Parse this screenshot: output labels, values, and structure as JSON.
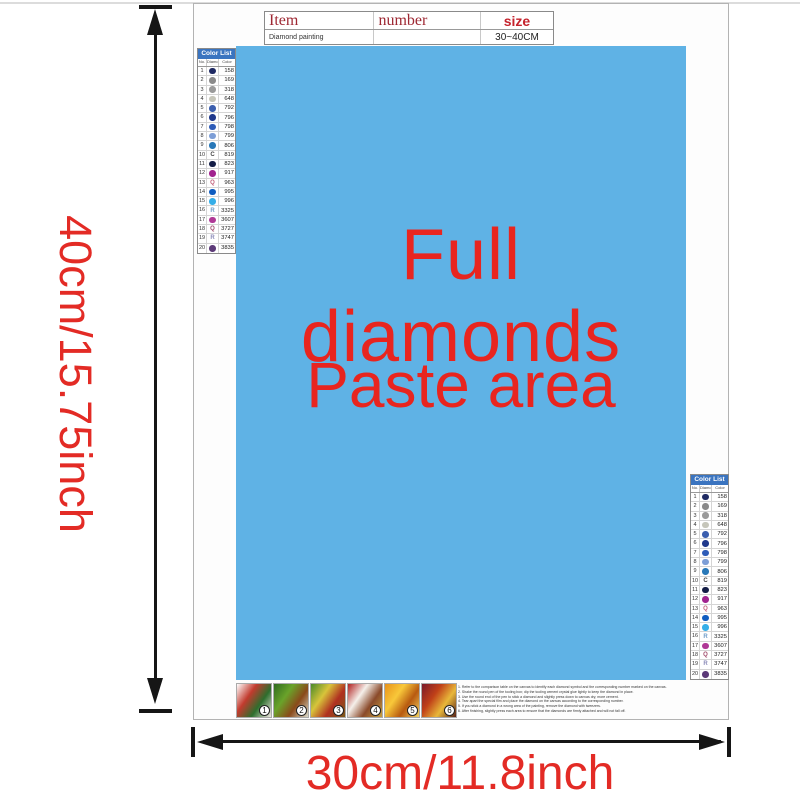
{
  "dimensions": {
    "height_label": "40cm/15.75inch",
    "width_label": "30cm/11.8inch"
  },
  "header_table": {
    "columns": [
      "Item",
      "number",
      "size"
    ],
    "row": {
      "item": "Diamond painting",
      "number": "",
      "size": "30~40CM"
    }
  },
  "paste_area": {
    "line1": "Full diamonds",
    "line2": "Paste area",
    "bg_color": "#5fb2e5",
    "text_color": "#e8251f"
  },
  "color_list": {
    "title": "Color List",
    "columns": [
      "No.",
      "Diamond",
      "Color"
    ],
    "header_bg": "#3a74c0",
    "rows": [
      {
        "no": "1",
        "type": "dot",
        "glyph": "",
        "color": "#1f2a63",
        "code": "158"
      },
      {
        "no": "2",
        "type": "dot",
        "glyph": "",
        "color": "#8a8a8a",
        "code": "169"
      },
      {
        "no": "3",
        "type": "dot",
        "glyph": "",
        "color": "#9a9a9a",
        "code": "318"
      },
      {
        "no": "4",
        "type": "dot",
        "glyph": "",
        "color": "#c6c6ba",
        "code": "648"
      },
      {
        "no": "5",
        "type": "dot",
        "glyph": "",
        "color": "#3c5fae",
        "code": "792"
      },
      {
        "no": "6",
        "type": "dot",
        "glyph": "",
        "color": "#20398c",
        "code": "796"
      },
      {
        "no": "7",
        "type": "dot",
        "glyph": "",
        "color": "#2e5cb8",
        "code": "798"
      },
      {
        "no": "8",
        "type": "dot",
        "glyph": "",
        "color": "#7d9ed6",
        "code": "799"
      },
      {
        "no": "9",
        "type": "dot",
        "glyph": "",
        "color": "#2878b8",
        "code": "806"
      },
      {
        "no": "10",
        "type": "letter",
        "glyph": "C",
        "color": "#444444",
        "code": "819"
      },
      {
        "no": "11",
        "type": "dot",
        "glyph": "",
        "color": "#141d46",
        "code": "823"
      },
      {
        "no": "12",
        "type": "dot",
        "glyph": "",
        "color": "#a1248f",
        "code": "917"
      },
      {
        "no": "13",
        "type": "letter",
        "glyph": "Q",
        "color": "#c2607a",
        "code": "963"
      },
      {
        "no": "14",
        "type": "dot",
        "glyph": "",
        "color": "#0f5cc0",
        "code": "995"
      },
      {
        "no": "15",
        "type": "dot",
        "glyph": "",
        "color": "#35aee8",
        "code": "996"
      },
      {
        "no": "16",
        "type": "letter",
        "glyph": "R",
        "color": "#6f9cc8",
        "code": "3325"
      },
      {
        "no": "17",
        "type": "dot",
        "glyph": "",
        "color": "#b03896",
        "code": "3607"
      },
      {
        "no": "18",
        "type": "letter",
        "glyph": "Q",
        "color": "#a04a6a",
        "code": "3727"
      },
      {
        "no": "19",
        "type": "letter",
        "glyph": "R",
        "color": "#8a8ab8",
        "code": "3747"
      },
      {
        "no": "20",
        "type": "dot",
        "glyph": "",
        "color": "#5c3a78",
        "code": "3835"
      }
    ]
  },
  "steps": {
    "items": [
      {
        "num": "1",
        "palette": [
          "#ffffff",
          "#c23b2e",
          "#2d6e2d",
          "#f0e8e0"
        ]
      },
      {
        "num": "2",
        "palette": [
          "#2f6b1f",
          "#6aa32a",
          "#8a4a1a",
          "#d8d8c8"
        ]
      },
      {
        "num": "3",
        "palette": [
          "#4a8a2a",
          "#d8c43a",
          "#b03020",
          "#7a5a18"
        ]
      },
      {
        "num": "4",
        "palette": [
          "#b02020",
          "#f5f0ea",
          "#8a4a2a",
          "#c8a040"
        ]
      },
      {
        "num": "5",
        "palette": [
          "#e8921a",
          "#f8c83a",
          "#b85a10",
          "#f0d060"
        ]
      },
      {
        "num": "6",
        "palette": [
          "#7a1a2a",
          "#c04018",
          "#e8b83a",
          "#5a2418"
        ]
      }
    ]
  },
  "instructions": {
    "lines": [
      "1. Refer to the comparison table on the canvas to identify each diamond symbol and the corresponding number marked on the canvas.",
      "2. Shake the round pen of the tooling box; dip the tooling cement crystal glue lightly to keep the diamond in place.",
      "3. Use the round end of the pen to stick a diamond and slightly press down to canvas dry, more cement.",
      "4. Tear apart the special film and place the diamond on the canvas according to the corresponding number.",
      "5. If you stick a diamond in a wrong area of the painting, remove the diamond with tweezers.",
      "6. After finishing, slightly press each area to ensure that the diamonds are firmly attached and will not fall off."
    ]
  },
  "colors": {
    "red": "#e32b25",
    "arrow": "#161616"
  }
}
